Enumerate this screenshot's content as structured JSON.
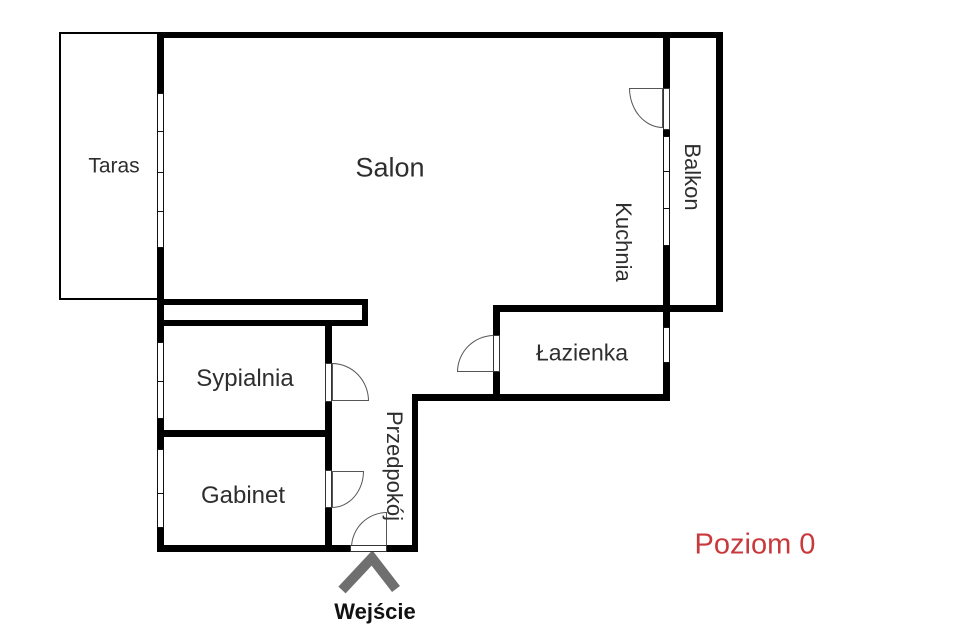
{
  "plan": {
    "level_label": "Poziom 0",
    "entrance_label": "Wejście",
    "rooms": [
      {
        "label": "Taras",
        "orientation": "horizontal"
      },
      {
        "label": "Salon",
        "orientation": "horizontal"
      },
      {
        "label": "Kuchnia",
        "orientation": "vertical"
      },
      {
        "label": "Balkon",
        "orientation": "vertical"
      },
      {
        "label": "Łazienka",
        "orientation": "horizontal"
      },
      {
        "label": "Sypialnia",
        "orientation": "horizontal"
      },
      {
        "label": "Gabinet",
        "orientation": "horizontal"
      },
      {
        "label": "Przedpokój",
        "orientation": "vertical"
      }
    ],
    "features": {
      "doors": [
        "kuchnia-balkon",
        "sypialnia",
        "gabinet",
        "lazienka",
        "entrance"
      ],
      "windows": [
        "taras-salon",
        "sypialnia",
        "gabinet",
        "kuchnia-balkon",
        "lazienka"
      ]
    },
    "colors": {
      "wall": "#000000",
      "room_text": "#2e2e2e",
      "level_text": "#c9393c",
      "entrance_arrow": "#6f6f6f",
      "background": "#ffffff"
    }
  }
}
